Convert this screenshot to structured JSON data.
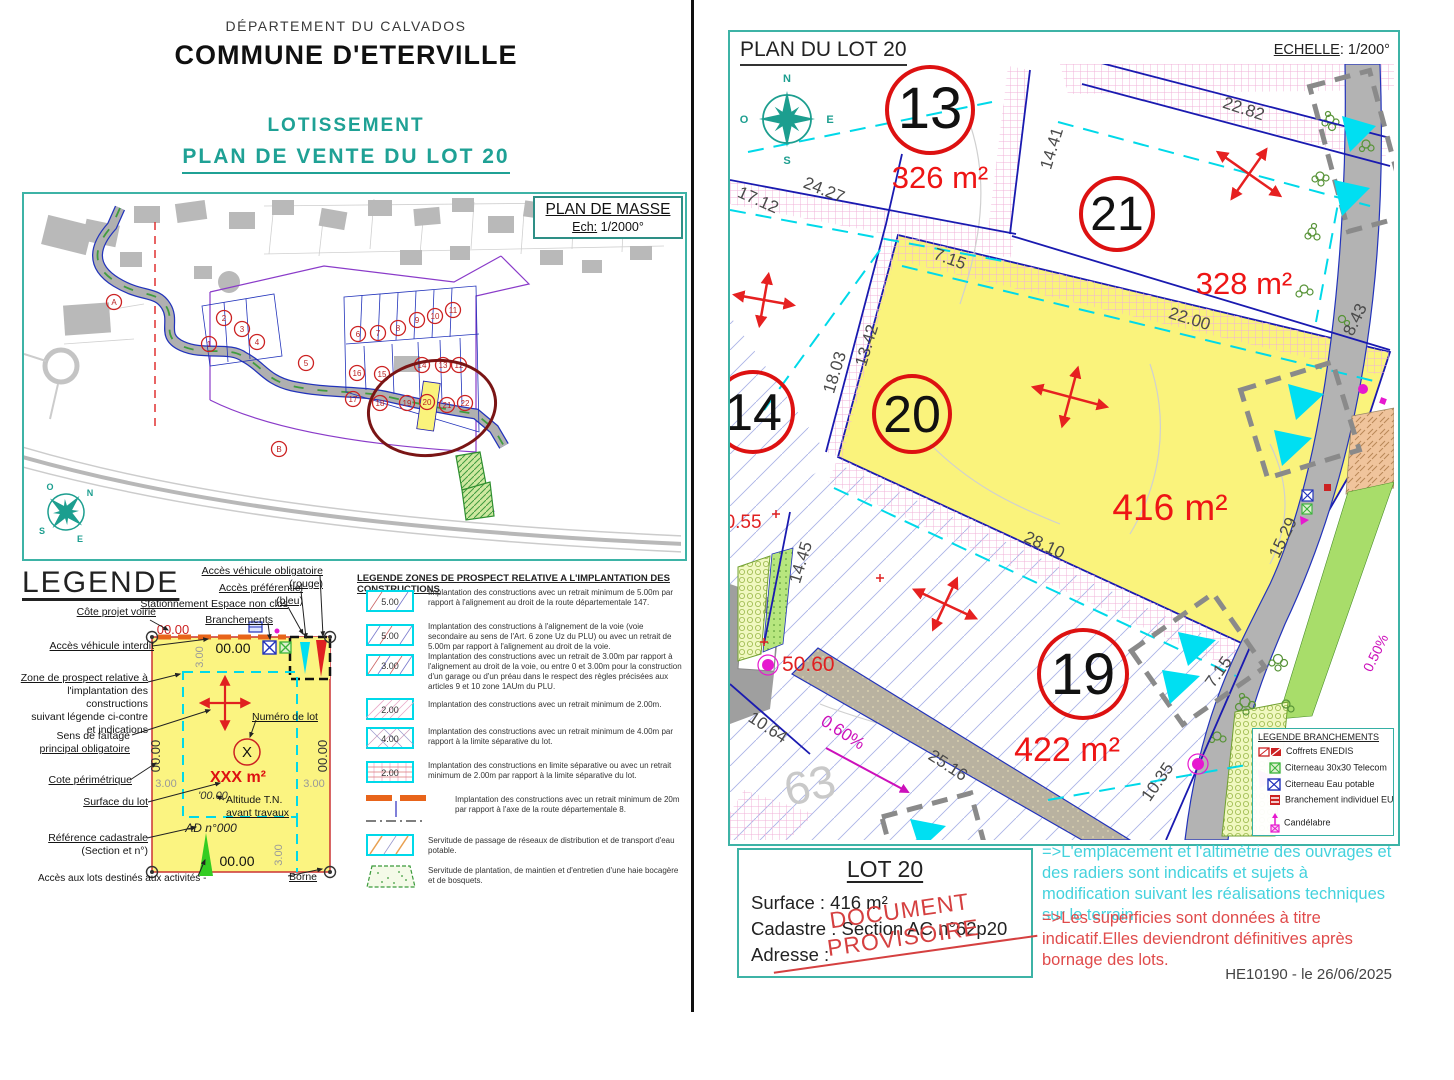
{
  "left_page": {
    "department": "DÉPARTEMENT DU CALVADOS",
    "commune": "COMMUNE D'ETERVILLE",
    "subtitle": "LOTISSEMENT",
    "title": "PLAN DE VENTE DU LOT 20",
    "plan_masse": {
      "title": "PLAN DE MASSE",
      "scale_label": "Ech:",
      "scale_value": "1/2000°",
      "compass": {
        "n": "N",
        "e": "E",
        "s": "S",
        "o": "O"
      },
      "lots": [
        "1",
        "2",
        "3",
        "4",
        "5",
        "6",
        "7",
        "8",
        "9",
        "10",
        "11",
        "12",
        "13",
        "14",
        "15",
        "16",
        "17",
        "18",
        "19",
        "20",
        "21",
        "22"
      ],
      "zones": [
        "A",
        "B"
      ]
    },
    "legende": {
      "title": "LEGENDE",
      "callouts": {
        "cote_projet_voirie": "Côte projet voirie",
        "acces_interdit": "Accès véhicule interdit",
        "zone_prospect_1": "Zone de prospect relative à",
        "zone_prospect_rest": "l'implantation des constructions\nsuivant légende ci-contre\net indications",
        "sens_faitage_1": "Sens de faîtage",
        "sens_faitage_2": "principal obligatoire",
        "cote_perimetrique": "Cote périmétrique",
        "surface_lot": "Surface du lot",
        "reference_cadastrale_1": "Référence cadastrale",
        "reference_cadastrale_2": "(Section et n°)",
        "acces_activites": "Accès aux lots destinés aux activités -",
        "acces_obligatoire": "Accès véhicule obligatoire (rouge)",
        "acces_preferentiel": "Accès préférentiel (bleu)",
        "stationnement": "Stationnement Espace non clos",
        "branchements": "Branchements",
        "numero_lot": "Numéro de lot",
        "altitude_1": "Altitude T.N.",
        "altitude_2": "avant travaux",
        "borne": "Borne"
      },
      "schematic": {
        "cote_voirie_value": "00.00",
        "cote_top": "00.00",
        "cote_left": "00.00",
        "cote_right": "00.00",
        "cote_bottom": "00.00",
        "retrait_top": "3.00",
        "retrait_left": "3.00",
        "retrait_right": "3.00",
        "retrait_bottom": "3.00",
        "lot_number": "X",
        "surface": "XXX m²",
        "altitude": "'00.00",
        "cadastre": "AD n°000"
      }
    },
    "legend_zones": {
      "title": "LEGENDE ZONES DE PROSPECT RELATIVE A L'IMPLANTATION DES CONSTRUCTIONS",
      "items": [
        {
          "label": "5.00",
          "text": "Implantation des constructions avec un retrait minimum de 5.00m par rapport à l'alignement au droit de la route départementale 147."
        },
        {
          "label": "5.00",
          "text": "Implantation des constructions à l'alignement de la voie (voie secondaire au sens de l'Art. 6 zone Uz du PLU) ou avec un retrait de 5.00m par rapport à l'alignement au droit de la voie."
        },
        {
          "label": "3.00",
          "text": "Implantation des constructions avec un retrait de 3.00m par rapport à l'alignement au droit de la voie, ou entre 0 et 3.00m pour la construction d'un garage ou d'un préau dans le respect des règles précisées aux articles 9 et 10 zone 1AUm du PLU."
        },
        {
          "label": "2.00",
          "text": "Implantation des constructions avec un retrait minimum de 2.00m."
        },
        {
          "label": "4.00",
          "text": "Implantation des constructions avec un retrait minimum de 4.00m par rapport à la limite séparative du lot."
        },
        {
          "label": "2.00",
          "text": "Implantation des constructions en limite séparative ou avec un retrait minimum de 2.00m par rapport à la limite séparative du lot."
        },
        {
          "label": "",
          "text": "Implantation des constructions avec un retrait minimum de 20m par rapport à l'axe de la route départementale 8."
        },
        {
          "label": "",
          "text": "Servitude de passage de réseaux de distribution et de transport d'eau potable."
        },
        {
          "label": "",
          "text": "Servitude de plantation, de maintien et d'entretien d'une haie bocagère et de bosquets."
        }
      ]
    }
  },
  "right_page": {
    "header": {
      "title": "PLAN DU LOT 20",
      "scale_label": "ECHELLE",
      "scale_value": ": 1/200°"
    },
    "plan": {
      "compass": {
        "n": "N",
        "e": "E",
        "s": "S",
        "o": "O"
      },
      "lots": [
        {
          "number": "13",
          "area": "326 m²"
        },
        {
          "number": "21",
          "area": "328 m²"
        },
        {
          "number": "20",
          "area": "416 m²"
        },
        {
          "number": "19",
          "area": "422 m²"
        },
        {
          "number": "14",
          "area": ""
        }
      ],
      "dims": {
        "d17_12": "17.12",
        "d24_27": "24.27",
        "d14_41": "14.41",
        "d22_82": "22.82",
        "d7_15": "7.15",
        "d13_42": "13.42",
        "d18_03": "18.03",
        "d22_00": "22.00",
        "d8_43": "8.43",
        "d28_10": "28.10",
        "d15_29": "15.29",
        "d14_45": "14.45",
        "d10_64": "10.64",
        "d25_16": "25.16",
        "d10_35": "10.35",
        "d7_15b": "7.15"
      },
      "levels": {
        "l50_55": "50.55",
        "l50_60": "50.60"
      },
      "slopes": {
        "s0_60": "0.60%",
        "s0_50": "0.50%"
      }
    },
    "legende_branchements": {
      "title": "LEGENDE BRANCHEMENTS",
      "items": [
        "Coffrets ENEDIS",
        "Citerneau 30x30 Telecom",
        "Citerneau Eau potable",
        "Branchement individuel EU",
        "Candélabre"
      ]
    },
    "info_box": {
      "title": "LOT 20",
      "surface": "Surface : 416 m²",
      "cadastre": "Cadastre : Section AC n°62p20",
      "adresse": "Adresse :",
      "stamp": "DOCUMENT  PROVISOIRE"
    },
    "notes": {
      "note_cyan": "=>L'emplacement et l'altimétrie des ouvrages et des radiers sont indicatifs et sujets à modification suivant les réalisations techniques sur le terrain.",
      "note_red": "=>Les superficies sont données à titre indicatif.Elles deviendront définitives après bornage des lots."
    },
    "footer": "HE10190 - le 26/06/2025"
  }
}
